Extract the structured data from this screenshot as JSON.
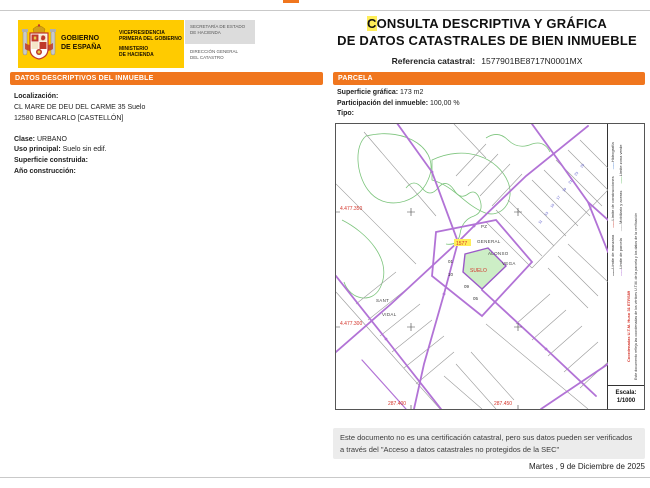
{
  "document": {
    "title_highlight": "C",
    "title_rest_line1": "ONSULTA DESCRIPTIVA Y GRÁFICA",
    "title_line2": "DE DATOS CATASTRALES DE BIEN INMUEBLE",
    "reference_label": "Referencia catastral:",
    "reference_value": "1577901BE8717N0001MX",
    "date": "Martes , 9 de Diciembre de 2025",
    "footer_note": "Este documento no es una certificación catastral, pero sus datos pueden ser verificados a través del \"Acceso a datos catastrales no protegidos de la SEC\""
  },
  "header": {
    "gobierno_line1": "GOBIERNO",
    "gobierno_line2": "DE ESPAÑA",
    "dept1_line1": "VICEPRESIDENCIA",
    "dept1_line2": "PRIMERA DEL GOBIERNO",
    "dept2_line1": "MINISTERIO",
    "dept2_line2": "DE HACIENDA",
    "sub1_line1": "SECRETARÍA DE ESTADO",
    "sub1_line2": "DE HACIENDA",
    "sub2_line1": "DIRECCIÓN GENERAL",
    "sub2_line2": "DEL CATASTRO"
  },
  "datos_panel": {
    "header": "DATOS DESCRIPTIVOS DEL INMUEBLE",
    "localizacion_label": "Localización:",
    "address_line1": "CL MARE DE DEU DEL CARME 35 Suelo",
    "address_line2": "12580 BENICARLO [CASTELLÓN]",
    "clase_label": "Clase:",
    "clase_value": "URBANO",
    "uso_label": "Uso principal:",
    "uso_value": "Suelo sin edif.",
    "superficie_label": "Superficie construida:",
    "anio_label": "Año construcción:"
  },
  "parcela_panel": {
    "header": "PARCELA",
    "superficie_label": "Superficie gráfica:",
    "superficie_value": "173 m2",
    "participacion_label": "Participación del inmueble:",
    "participacion_value": "100,00 %",
    "tipo_label": "Tipo:"
  },
  "map": {
    "coord_top_left": "4.477.350",
    "coord_bottom_left": "4.477.300",
    "coord_bottom_x1": "287.400",
    "coord_bottom_x2": "287.450",
    "highlight_ref": "1577",
    "parcel_label": "SUELO",
    "street_labels": {
      "pz": "PZ",
      "general": "GENERAL",
      "alonso": "ALONSO",
      "vega": "VEGA",
      "sant": "SANT",
      "vidal": "VIDAL"
    },
    "parcel_numbers": [
      "01",
      "10",
      "09",
      "05"
    ],
    "portal_numbers": [
      "11",
      "13",
      "15",
      "17",
      "19",
      "21",
      "23",
      "25"
    ],
    "legend": {
      "items": [
        {
          "label": "Límite de manzana",
          "color": "#222222"
        },
        {
          "label": "Límite de construcciones",
          "color": "#cc4a3c"
        },
        {
          "label": "Hidrografía",
          "color": "#5b8dd6"
        },
        {
          "label": "Límite de parcela",
          "color": "#b273d6"
        },
        {
          "label": "Mobiliario y aceras",
          "color": "#9a9a9a"
        },
        {
          "label": "Límite zona verde",
          "color": "#6abf69"
        }
      ],
      "utm_note": "Coordenadas U.T.M. Huso 31 ETRS89",
      "side_note": "Este documento refleja las coordenadas de los vértices U.T.M. de la parcela y los datos de la verificación",
      "scale_label": "Escala:",
      "scale_value": "1/1000"
    }
  },
  "colors": {
    "accent_orange": "#F0761E",
    "logo_yellow": "#FFCB00",
    "highlight_yellow": "#FFEE58",
    "map_purple": "#B273D6",
    "parcel_green_fill": "#CDEEC6",
    "map_red": "#D4342A"
  }
}
